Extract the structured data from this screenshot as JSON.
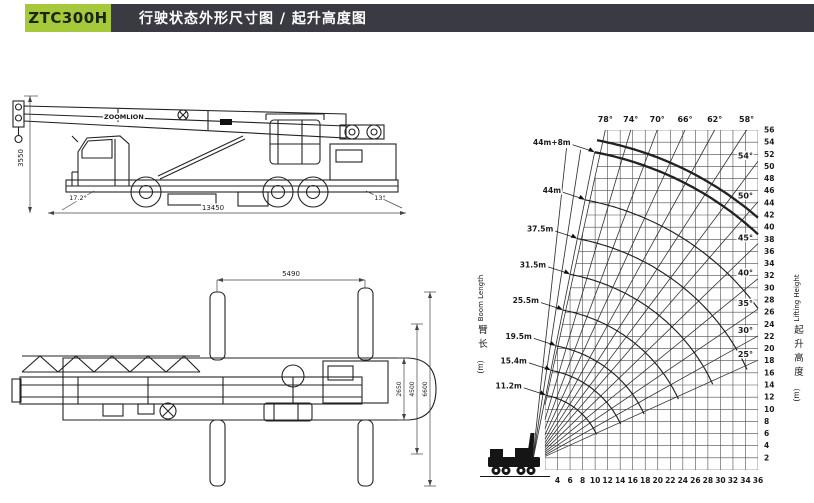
{
  "header": {
    "model": "ZTC300H",
    "title": "行驶状态外形尺寸图 / 起升高度图",
    "accent_color": "#a6c93c",
    "bar_color": "#3a3a42"
  },
  "side_view": {
    "brand": "ZOOMLION",
    "height_mm": "3550",
    "length_mm": "13450",
    "front_angle": "17.2°",
    "rear_angle": "13°"
  },
  "top_view": {
    "outrigger_longitudinal_mm": "5490",
    "span_inner_mm": "2650",
    "span_mid_mm": "4500",
    "span_outer_mm": "6600"
  },
  "chart_data": {
    "type": "line",
    "title": "起升高度图",
    "x_range": [
      2,
      36
    ],
    "y_range": [
      0,
      56
    ],
    "x_ticks": [
      4,
      6,
      8,
      10,
      12,
      14,
      16,
      18,
      20,
      22,
      24,
      26,
      28,
      30,
      32,
      34,
      36
    ],
    "y_ticks": [
      2,
      4,
      6,
      8,
      10,
      12,
      14,
      16,
      18,
      20,
      22,
      24,
      26,
      28,
      30,
      32,
      34,
      36,
      38,
      40,
      42,
      44,
      46,
      48,
      50,
      52,
      54,
      56
    ],
    "grid": true,
    "boom_angles_top": [
      78,
      74,
      70,
      66,
      62,
      58
    ],
    "boom_angles_right": [
      54,
      50,
      45,
      40,
      35,
      30,
      25
    ],
    "boom_lengths": [
      {
        "label": "11.2m",
        "meters": 11.2
      },
      {
        "label": "15.4m",
        "meters": 15.4
      },
      {
        "label": "19.5m",
        "meters": 19.5
      },
      {
        "label": "25.5m",
        "meters": 25.5
      },
      {
        "label": "31.5m",
        "meters": 31.5
      },
      {
        "label": "37.5m",
        "meters": 37.5
      },
      {
        "label": "44m",
        "meters": 44
      },
      {
        "label": "44m+8m",
        "meters": 52,
        "thick": true,
        "curves": [
          52,
          54
        ]
      }
    ],
    "left_axis_title": {
      "zh": "臂长",
      "unit": "(m)",
      "en": "Boom Length"
    },
    "right_axis_title": {
      "zh": "起升高度",
      "unit": "(m)",
      "en": "Lifting Height"
    }
  }
}
